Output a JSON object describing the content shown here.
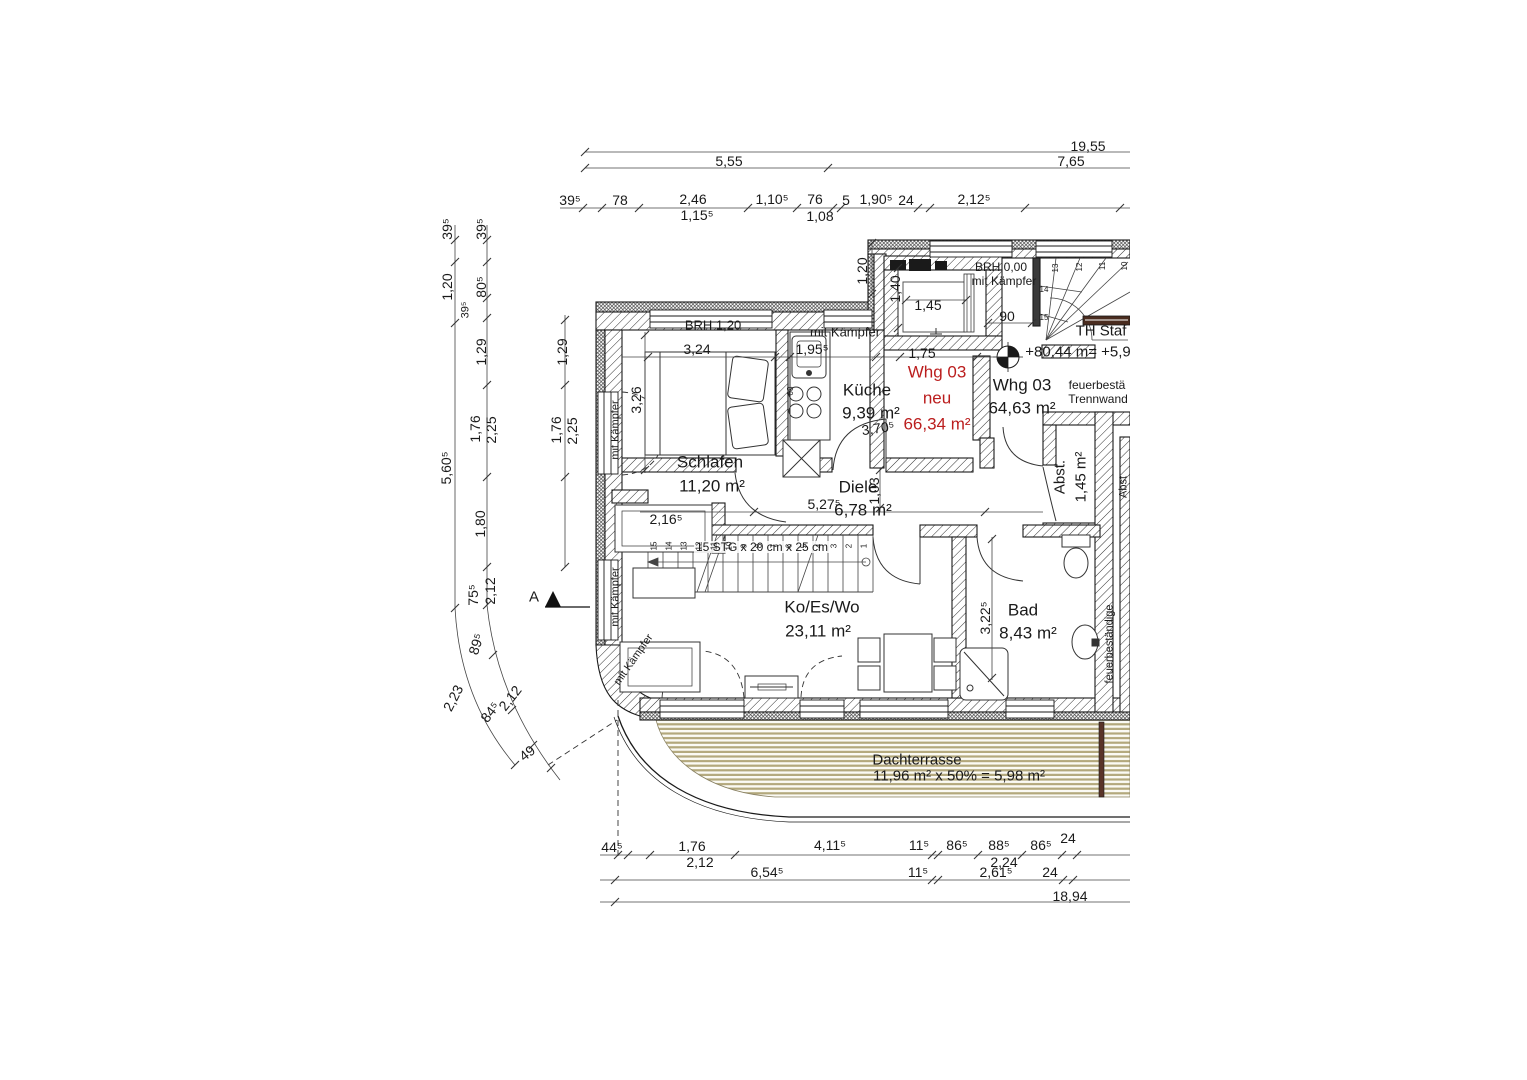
{
  "colors": {
    "red": "#bb1e1e",
    "deck": "#b3a87c",
    "rail": "#5a3428",
    "ink": "#1a1a1a"
  },
  "rooms": {
    "schlafen": {
      "name": "Schlafen",
      "area": "11,20 m²"
    },
    "kueche": {
      "name": "Küche",
      "area": "9,39 m²"
    },
    "diele": {
      "name": "Diele",
      "area": "6,78 m²"
    },
    "wohnen": {
      "name": "Ko/Es/Wo",
      "area": "23,11 m²"
    },
    "bad": {
      "name": "Bad",
      "area": "8,43 m²"
    },
    "abstellraum": {
      "name": "Abst.",
      "area": "1,45 m²"
    },
    "terrasse": {
      "name": "Dachterrasse",
      "area": "11,96 m² x 50% = 5,98 m²"
    }
  },
  "apartment": {
    "neu": {
      "l1": "Whg 03",
      "l2": "neu",
      "l3": "66,34 m²"
    },
    "alt": {
      "l1": "Whg 03",
      "l2": "64,63 m²"
    }
  },
  "annotations": {
    "brh_schlafzimmer": "BRH 1,20",
    "brh_flur": "BRH 0,00",
    "kaempfer": "mit Kämpfer",
    "treppenhaus": "TH Staf",
    "hoehe": "+80,44 m= +5,9",
    "trennwand_1": "feuerbestä",
    "trennwand_2": "Trennwand",
    "trennwand_seite": "feuerbeständige",
    "abst_nachbar": "Abst",
    "treppe": "15 STG x 20 cm x 25 cm",
    "schnitt": "A",
    "herd": "08"
  },
  "dims_top": {
    "total": "19,55",
    "left": "5,55",
    "right": "7,65",
    "row": [
      "39⁵",
      "78",
      "2,46",
      "1,10⁵",
      "76",
      "5",
      "1,90⁵",
      "24",
      "2,12⁵"
    ],
    "row_sub": [
      "1,15⁵",
      "1,08"
    ]
  },
  "dims_left": {
    "a": [
      "39⁵",
      "1,20",
      "5,60⁵",
      "2,23"
    ],
    "b": [
      "39⁵",
      "80⁵",
      "39⁵",
      "1,29",
      "1,76",
      "2,25",
      "1,80",
      "75⁵",
      "2,12",
      "89⁵",
      "84⁵",
      "2,12",
      "49"
    ],
    "c": [
      "1,29",
      "1,76",
      "2,25"
    ]
  },
  "dims_bottom": {
    "row1": [
      "44⁵",
      "1,76",
      "4,11⁵",
      "11⁵",
      "86⁵",
      "88⁵",
      "86⁵",
      "24"
    ],
    "row1_sub": [
      "2,12",
      "2,24"
    ],
    "row2": [
      "6,54⁵",
      "11⁵",
      "2,61⁵",
      "24"
    ],
    "total": "18,94"
  },
  "dims_innen": {
    "schlafen_b": "3,24",
    "schlafen_t": "3,26",
    "kueche_b": "1,95⁵",
    "kueche_t": "3,70⁵",
    "flur_b": "1,75",
    "flur_h": "1,20",
    "aufzug_b": "1,45",
    "aufzug_t": "1,40",
    "podest": "90",
    "diele_l": "5,27⁵",
    "diele_t": "1,03",
    "schrank": "2,16⁵",
    "bad_t": "3,22⁵"
  },
  "stairs": {
    "innen": [
      "15",
      "14",
      "13",
      "12",
      "11",
      "10",
      "9",
      "8",
      "7",
      "6",
      "5",
      "4",
      "3",
      "2",
      "1"
    ],
    "th": [
      "13",
      "12",
      "11",
      "10",
      "14",
      "15"
    ]
  }
}
